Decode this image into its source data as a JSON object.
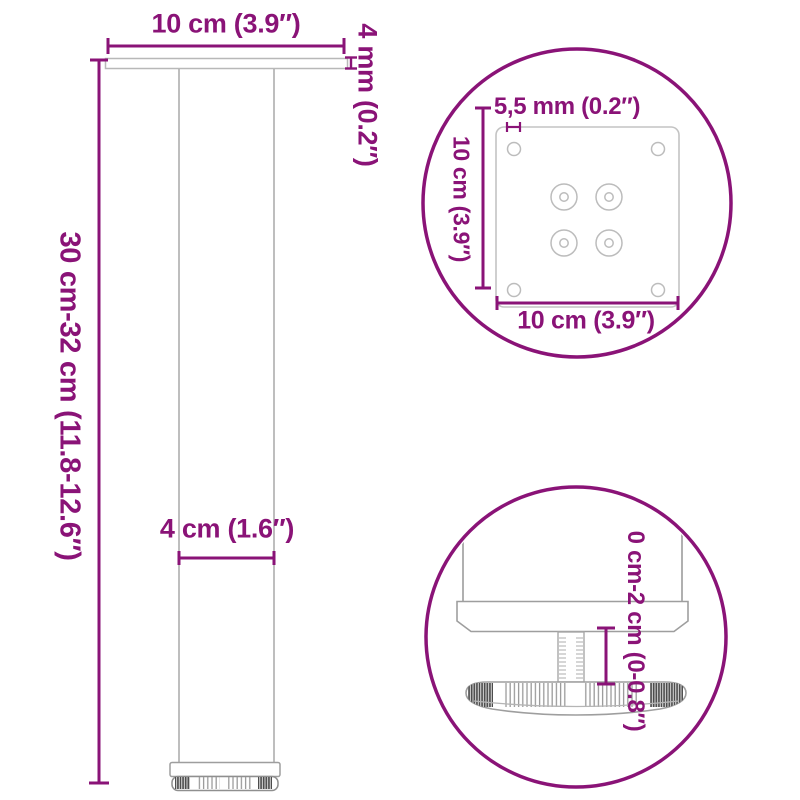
{
  "colors": {
    "accent": "#8a1377",
    "outline_light": "#bcbcbc",
    "outline_mid": "#9e9e9e"
  },
  "main_view": {
    "labels": {
      "top_width": "10 cm (3.9″)",
      "plate_thickness": "4 mm (0.2″)",
      "leg_height": "30 cm-32 cm (11.8-12.6″)",
      "tube_width": "4 cm (1.6″)"
    }
  },
  "plate_detail": {
    "labels": {
      "hole_diameter": "5,5 mm (0.2″)",
      "plate_depth": "10 cm (3.9″)",
      "plate_width": "10 cm (3.9″)"
    }
  },
  "foot_detail": {
    "labels": {
      "height_adjustment": "0 cm-2 cm (0-0.8″)"
    }
  }
}
